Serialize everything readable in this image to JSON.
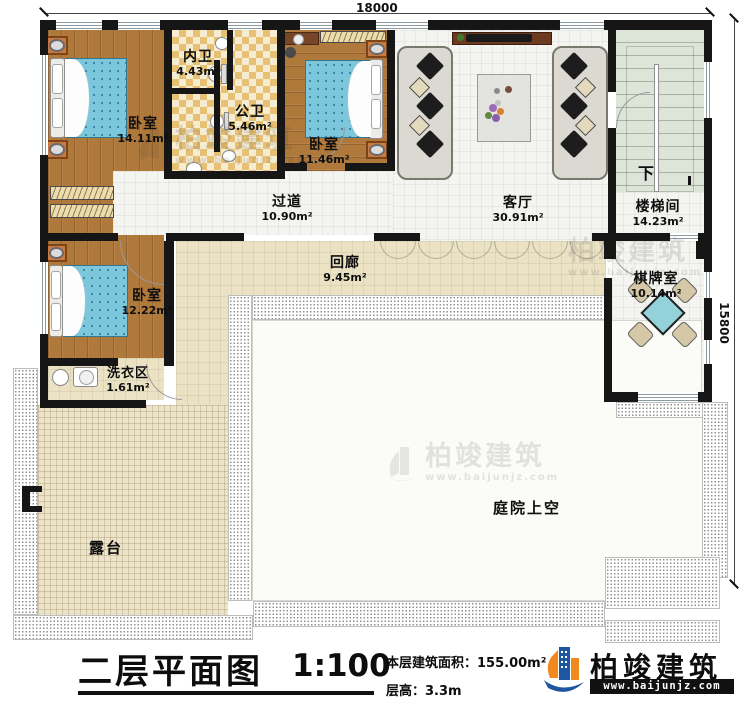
{
  "dimensions": {
    "width_label": "18000",
    "height_label": "15800"
  },
  "rooms": {
    "bedroom1": {
      "name": "卧室",
      "area": "14.11m²"
    },
    "inner_bath": {
      "name": "内卫",
      "area": "4.43m²"
    },
    "public_bath": {
      "name": "公卫",
      "area": "5.46m²"
    },
    "bedroom2": {
      "name": "卧室",
      "area": "11.46m²"
    },
    "hallway": {
      "name": "过道",
      "area": "10.90m²"
    },
    "living_room": {
      "name": "客厅",
      "area": "30.91m²"
    },
    "stairwell": {
      "name": "楼梯间",
      "area": "14.23m²"
    },
    "corridor": {
      "name": "回廊",
      "area": "9.45m²"
    },
    "bedroom3": {
      "name": "卧室",
      "area": "12.22m²"
    },
    "laundry": {
      "name": "洗衣区",
      "area": "1.61m²"
    },
    "chess_room": {
      "name": "棋牌室",
      "area": "10.14m²"
    },
    "terrace": {
      "name": "露台"
    },
    "courtyard": {
      "name": "庭院上空"
    },
    "stairs_down": {
      "label": "下"
    }
  },
  "title": {
    "text": "二层平面图",
    "scale": "1:100",
    "floor_area": "本层建筑面积：155.00m²",
    "floor_height": "层高：3.3m"
  },
  "logo": {
    "name": "柏竣建筑",
    "url": "www.baijunjz.com"
  },
  "watermark": {
    "name": "柏竣建筑",
    "url": "www.baijunjz.com"
  },
  "colors": {
    "wall": "#161616",
    "wood_floor": "#b0793c",
    "bed": "#7cc7db",
    "bath_tile": "#e7c173",
    "corridor_tile": "#ebe2c4",
    "stair": "#dde4d8",
    "mahjong_table": "#93d2d8",
    "logo_blue": "#1e56a0",
    "logo_orange": "#f08a1e"
  }
}
